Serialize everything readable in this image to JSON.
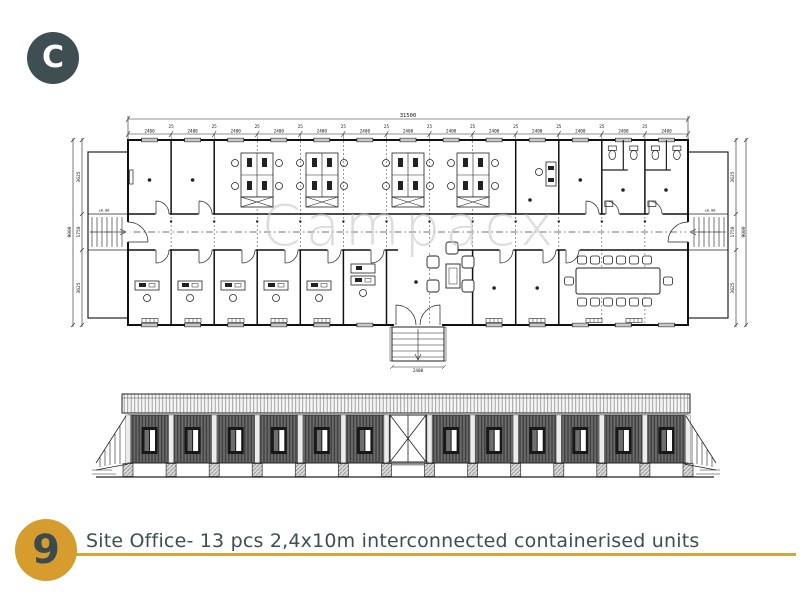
{
  "logo": {
    "letter": "C"
  },
  "watermark": {
    "text": "Campacx"
  },
  "caption": {
    "number": "9",
    "text": "Site Office- 13 pcs 2,4x10m interconnected containerised units"
  },
  "colors": {
    "brand_teal": "#3E4E52",
    "brand_gold": "#D69C2E",
    "underline_gold": "#D9A43A",
    "watermark_gray": "#C7C7C7",
    "drawing_line": "#222222"
  },
  "drawing": {
    "type": "floor-plan-and-elevation",
    "modules": 13,
    "dims": {
      "total_width": "31500",
      "module_width": "2400",
      "module_gap": "25",
      "total_depth": "9000",
      "room_depth": "3625",
      "corridor_depth": "1750",
      "entrance_width": "2400",
      "level": "±0.00"
    }
  }
}
